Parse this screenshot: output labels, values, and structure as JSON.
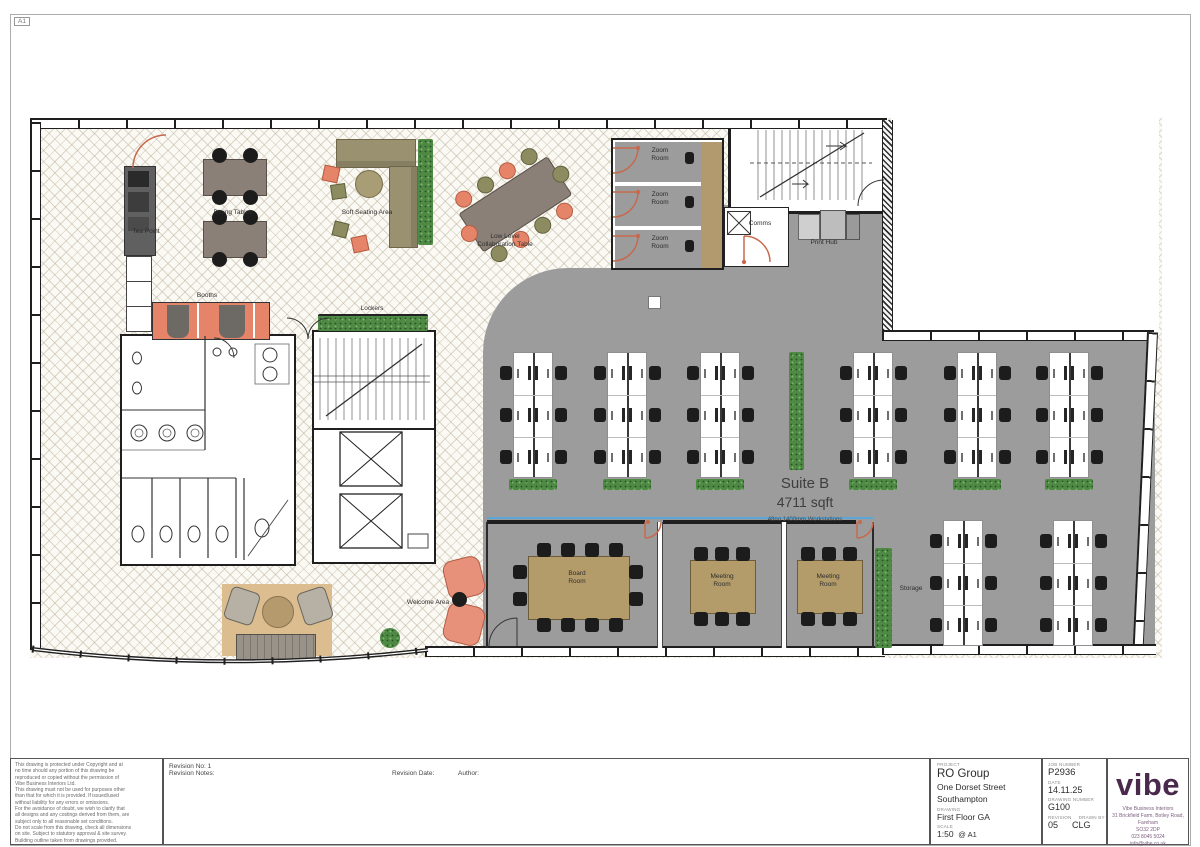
{
  "sheet": {
    "format": "A1"
  },
  "suite": {
    "name": "Suite B",
    "area": "4711 sqft",
    "workstations": "48no 1400mm Workstations"
  },
  "plan": {
    "labels": [
      {
        "t": "Tea Point",
        "x": 146,
        "y": 228
      },
      {
        "t": "Dining Tables",
        "x": 233,
        "y": 209
      },
      {
        "t": "Soft Seating Area",
        "x": 367,
        "y": 209
      },
      {
        "t": "Low Level\nCollaboration Table",
        "x": 505,
        "y": 233
      },
      {
        "t": "Booths",
        "x": 207,
        "y": 292
      },
      {
        "t": "Lockers",
        "x": 372,
        "y": 305
      },
      {
        "t": "Zoom\nRoom",
        "x": 660,
        "y": 147
      },
      {
        "t": "Zoom\nRoom",
        "x": 660,
        "y": 191
      },
      {
        "t": "Zoom\nRoom",
        "x": 660,
        "y": 235
      },
      {
        "t": "Comms",
        "x": 760,
        "y": 220
      },
      {
        "t": "Print Hub",
        "x": 824,
        "y": 239
      },
      {
        "t": "Board\nRoom",
        "x": 577,
        "y": 570
      },
      {
        "t": "Meeting\nRoom",
        "x": 722,
        "y": 573
      },
      {
        "t": "Meeting\nRoom",
        "x": 828,
        "y": 573
      },
      {
        "t": "Storage",
        "x": 911,
        "y": 585
      },
      {
        "t": "Welcome Area",
        "x": 428,
        "y": 599
      },
      {
        "t": "Suite B",
        "x": 805,
        "y": 475,
        "cls": "big"
      },
      {
        "t": "4711 sqft",
        "x": 805,
        "y": 494,
        "cls": "big2"
      },
      {
        "t": "48no 1400mm Workstations",
        "x": 805,
        "y": 517,
        "cls": "tiny"
      }
    ],
    "desk_clusters": [
      {
        "x": 500,
        "y": 352,
        "p": true
      },
      {
        "x": 594,
        "y": 352,
        "p": true
      },
      {
        "x": 687,
        "y": 352,
        "p": true
      },
      {
        "x": 840,
        "y": 352,
        "p": true
      },
      {
        "x": 944,
        "y": 352,
        "p": true
      },
      {
        "x": 1036,
        "y": 352,
        "p": true
      },
      {
        "x": 930,
        "y": 520,
        "p": false
      },
      {
        "x": 1040,
        "y": 520,
        "p": false
      }
    ]
  },
  "notes": {
    "lines": [
      "This drawing is protected under Copyright and at",
      "no time should any portion of this drawing be",
      "reproduced or copied without the permission of",
      "Vibe Business Interiors Ltd.",
      "This drawing must not be used for purposes other",
      "than that for which it is provided. If issued/used",
      "without liability for any errors or omissions.",
      "For the avoidance of doubt, we wish to clarify that",
      "all designs and any costings derived from them, are",
      "subject only to all reasonable set conditions.",
      "Do not scale from this drawing, check all dimensions",
      "on site. Subject to statutory approval & site survey.",
      "Building outline taken from drawings provided."
    ]
  },
  "revision": {
    "no": "Revision No: 1",
    "notes": "Revision Notes:",
    "date": "Revision Date:",
    "author": "Author:"
  },
  "title_block": {
    "project_label": "PROJECT",
    "project": "RO Group",
    "address1": "One Dorset Street",
    "address2": "Southampton",
    "drawing_label": "DRAWING",
    "drawing": "First Floor GA",
    "scale_label": "SCALE",
    "scale": "1:50",
    "scale_at": "@ A1",
    "job_label": "JOB NUMBER",
    "job": "P2936",
    "date_label": "DATE",
    "date": "14.11.25",
    "dwg_no_label": "DRAWING NUMBER",
    "dwg_no": "G100",
    "rev_label": "REVISION",
    "rev": "05",
    "drawn_label": "DRAWN BY",
    "drawn": "CLG"
  },
  "logo": {
    "name": "vibe",
    "address_lines": [
      "Vibe Business Interiors",
      "31 Brickfield Farm, Botley Road, Fareham",
      "SO32 2DP",
      "023 8045 5024",
      "info@vibe.co.uk"
    ]
  },
  "colors": {
    "plan_gray": "#9c9c9c",
    "coral": "#e58468",
    "planter_green": "#4f8a45",
    "table_tan": "#b49c6a",
    "timber": "#b29a6e",
    "logo_purple": "#4a2a4c",
    "wall": "#1f1f1f",
    "glazing_blue": "#58a7d8"
  }
}
